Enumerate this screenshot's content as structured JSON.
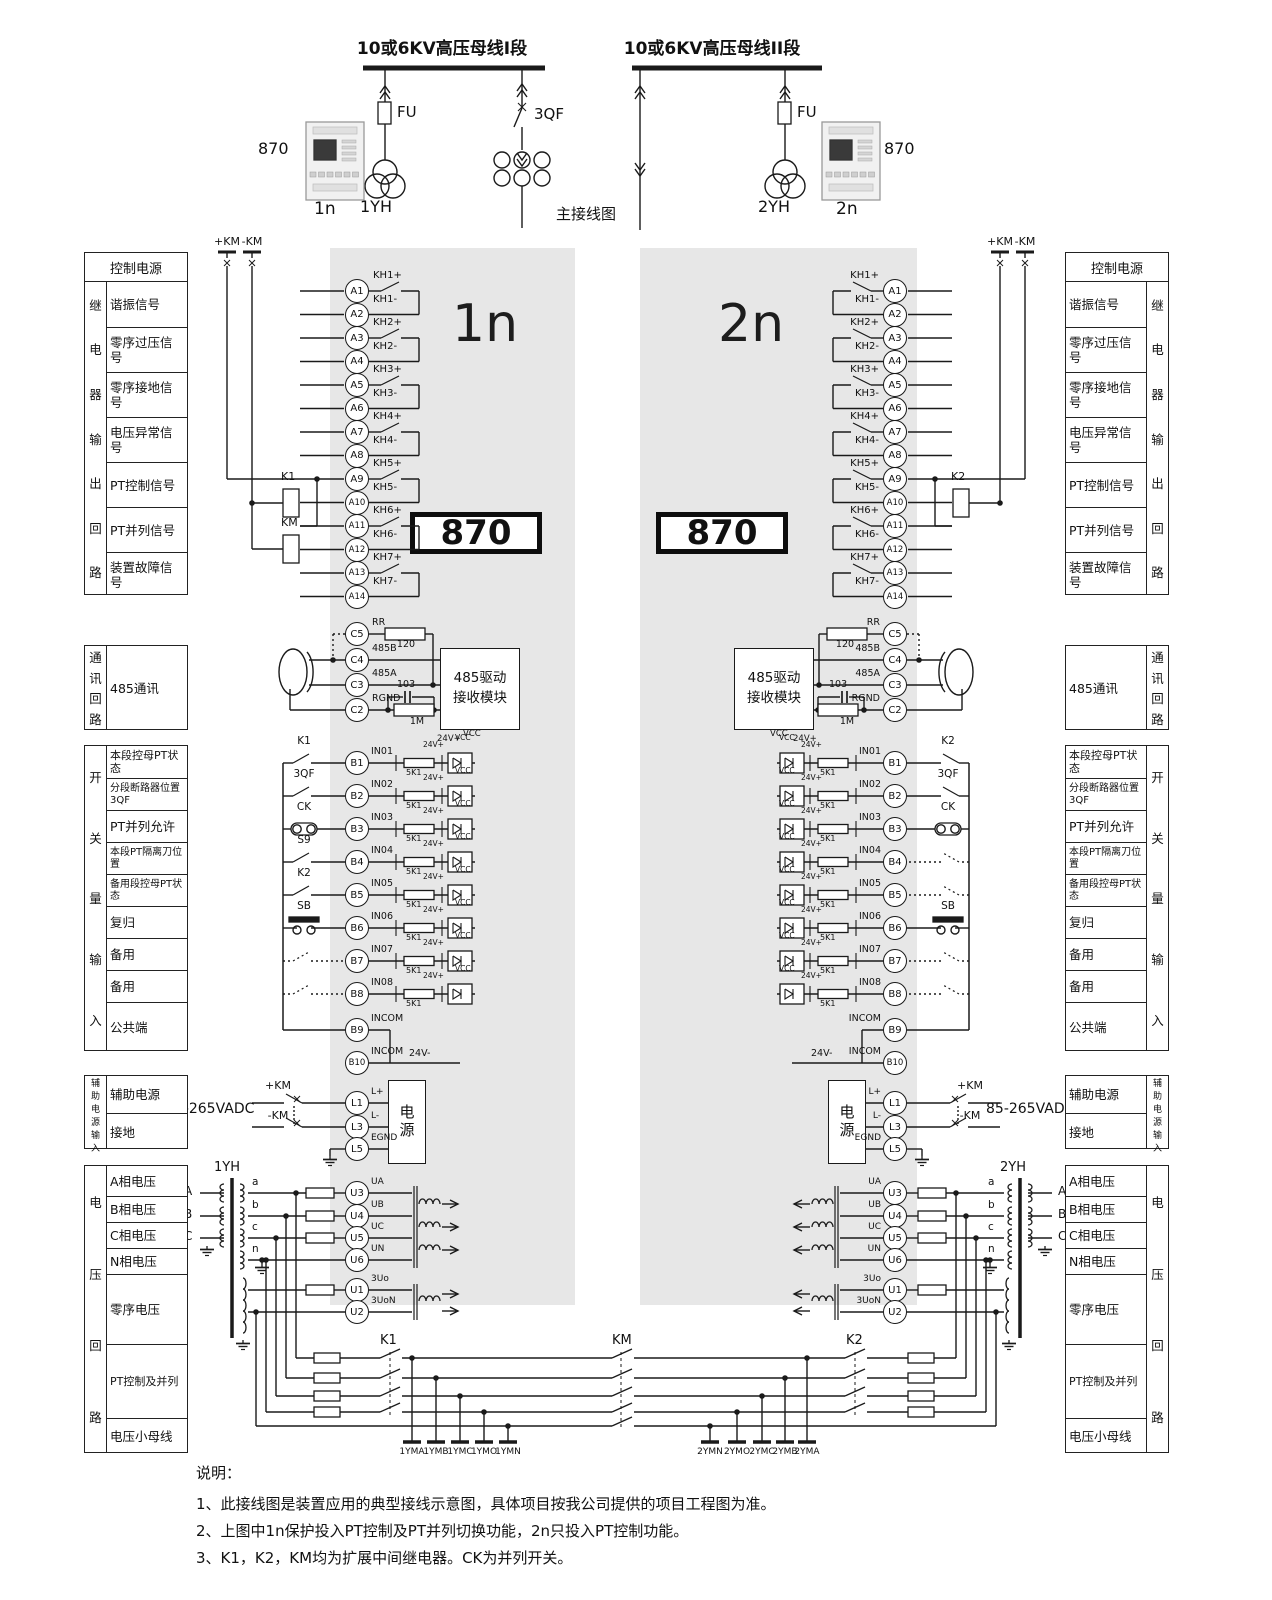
{
  "top": {
    "bus1": "10或6KV高压母线I段",
    "bus2": "10或6KV高压母线II段",
    "fu": "FU",
    "qf": "3QF",
    "pt1": "1YH",
    "pt2": "2YH",
    "device": "870",
    "n1": "1n",
    "n2": "2n",
    "main_label": "主接线图"
  },
  "panels": {
    "left_title": "1n",
    "right_title": "2n",
    "device": "870"
  },
  "sidebars": {
    "control": {
      "header": "控制电源",
      "vertical": "继电器输出回路",
      "rows": [
        "谐振信号",
        "零序过压信号",
        "零序接地信号",
        "电压异常信号",
        "PT控制信号",
        "PT并列信号",
        "装置故障信号"
      ]
    },
    "comm": {
      "vertical": "通讯回路",
      "rows": [
        "485通讯"
      ]
    },
    "di": {
      "vertical": "开关量输入",
      "rows": [
        "本段控母PT状态",
        "分段断路器位置3QF",
        "PT并列允许",
        "本段PT隔离刀位置",
        "备用段控母PT状态",
        "复归",
        "备用",
        "备用",
        "公共端"
      ]
    },
    "aux": {
      "vertical": "辅助电源输入",
      "rows": [
        "辅助电源",
        "接地"
      ]
    },
    "volt": {
      "vertical": "电压回路",
      "rows": [
        "A相电压",
        "B相电压",
        "C相电压",
        "N相电压",
        "零序电压",
        "PT控制及并列",
        "电压小母线"
      ]
    }
  },
  "terminals": {
    "a": [
      [
        "A1",
        "KH1+"
      ],
      [
        "A2",
        "KH1-"
      ],
      [
        "A3",
        "KH2+"
      ],
      [
        "A4",
        "KH2-"
      ],
      [
        "A5",
        "KH3+"
      ],
      [
        "A6",
        "KH3-"
      ],
      [
        "A7",
        "KH4+"
      ],
      [
        "A8",
        "KH4-"
      ],
      [
        "A9",
        "KH5+"
      ],
      [
        "A10",
        "KH5-"
      ],
      [
        "A11",
        "KH6+"
      ],
      [
        "A12",
        "KH6-"
      ],
      [
        "A13",
        "KH7+"
      ],
      [
        "A14",
        "KH7-"
      ]
    ],
    "c": [
      [
        "C5",
        "RR"
      ],
      [
        "C4",
        "485B"
      ],
      [
        "C3",
        "485A"
      ],
      [
        "C2",
        "RGND"
      ]
    ],
    "b": [
      [
        "B1",
        "IN01"
      ],
      [
        "B2",
        "IN02"
      ],
      [
        "B3",
        "IN03"
      ],
      [
        "B4",
        "IN04"
      ],
      [
        "B5",
        "IN05"
      ],
      [
        "B6",
        "IN06"
      ],
      [
        "B7",
        "IN07"
      ],
      [
        "B8",
        "IN08"
      ],
      [
        "B9",
        "INCOM"
      ],
      [
        "B10",
        "INCOM"
      ]
    ],
    "l": [
      [
        "L1",
        "L+"
      ],
      [
        "L3",
        "L-"
      ],
      [
        "L5",
        "EGND"
      ]
    ],
    "u": [
      [
        "U3",
        "UA"
      ],
      [
        "U4",
        "UB"
      ],
      [
        "U5",
        "UC"
      ],
      [
        "U6",
        "UN"
      ],
      [
        "U1",
        "3Uo"
      ],
      [
        "U2",
        "3UoN"
      ]
    ]
  },
  "di_switches": {
    "left": [
      "K1",
      "3QF",
      "CK",
      "S9",
      "K2",
      "SB",
      "",
      ""
    ],
    "right": [
      "K2",
      "3QF",
      "CK",
      "",
      "",
      "SB",
      "",
      ""
    ]
  },
  "comm_parts": {
    "module": "485驱动\n接收模块",
    "r_term": "120",
    "c_gnd": "103",
    "r_gnd": "1M"
  },
  "input_circuit": {
    "res": "5K1",
    "v24p": "24V+",
    "v24m": "24V-",
    "vcc": "VCC"
  },
  "power": {
    "box": "电源",
    "voltage": "85-265VADC",
    "km_plus": "+KM",
    "km_minus": "-KM"
  },
  "relays": {
    "k1": "K1",
    "k2": "K2",
    "km": "KM"
  },
  "pt": {
    "phases": [
      "A",
      "B",
      "C"
    ],
    "sec": [
      "a",
      "b",
      "c",
      "n"
    ],
    "left_buses": [
      "1YMA",
      "1YMB",
      "1YMC",
      "1YMO",
      "1YMN"
    ],
    "right_buses": [
      "2YMN",
      "2YMO",
      "2YMC",
      "2YMB",
      "2YMA"
    ]
  },
  "notes": {
    "title": "说明：",
    "items": [
      "1、此接线图是装置应用的典型接线示意图，具体项目按我公司提供的项目工程图为准。",
      "2、上图中1n保护投入PT控制及PT并列切换功能，2n只投入PT控制功能。",
      "3、K1，K2，KM均为扩展中间继电器。CK为并列开关。"
    ]
  }
}
